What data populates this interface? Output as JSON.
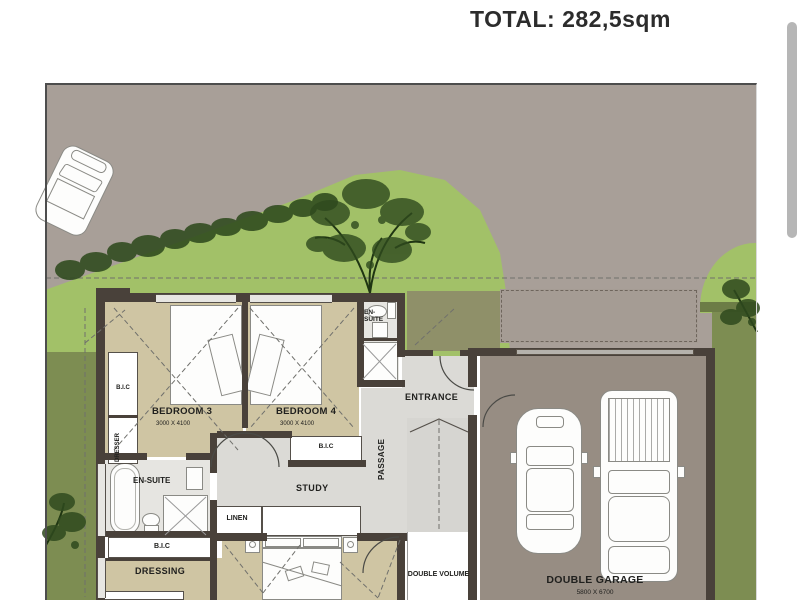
{
  "page": {
    "title": "TOTAL: 282,5sqm"
  },
  "plan": {
    "labels": {
      "bedroom3": "BEDROOM 3",
      "bedroom3_dims": "3000 X 4100",
      "bedroom4": "BEDROOM 4",
      "bedroom4_dims": "3000 X 4100",
      "ensuite": "EN-SUITE",
      "entrance": "ENTRANCE",
      "passage": "PASSAGE",
      "study": "STUDY",
      "linen": "LINEN",
      "bic": "B.I.C",
      "dresser": "DRESSER",
      "dressing": "DRESSING",
      "double_volume": "DOUBLE VOLUME",
      "double_garage": "DOUBLE GARAGE",
      "double_garage_dims": "5800 X 6700"
    },
    "colors": {
      "road": "#a89f98",
      "grass_light": "#a2c168",
      "grass_dark": "#7d8d52",
      "hedge": "#2f4a1e",
      "floor_tan": "#cfc5a3",
      "floor_gray": "#dbdad6",
      "bath": "#e6e5e1",
      "garage_floor": "#978d83",
      "wall": "#49413a",
      "deck": "#8f9069",
      "stairs": "#d6d5d1",
      "garage_door": "#b5b2ac",
      "scrollbar": "#b6b6b6"
    }
  }
}
